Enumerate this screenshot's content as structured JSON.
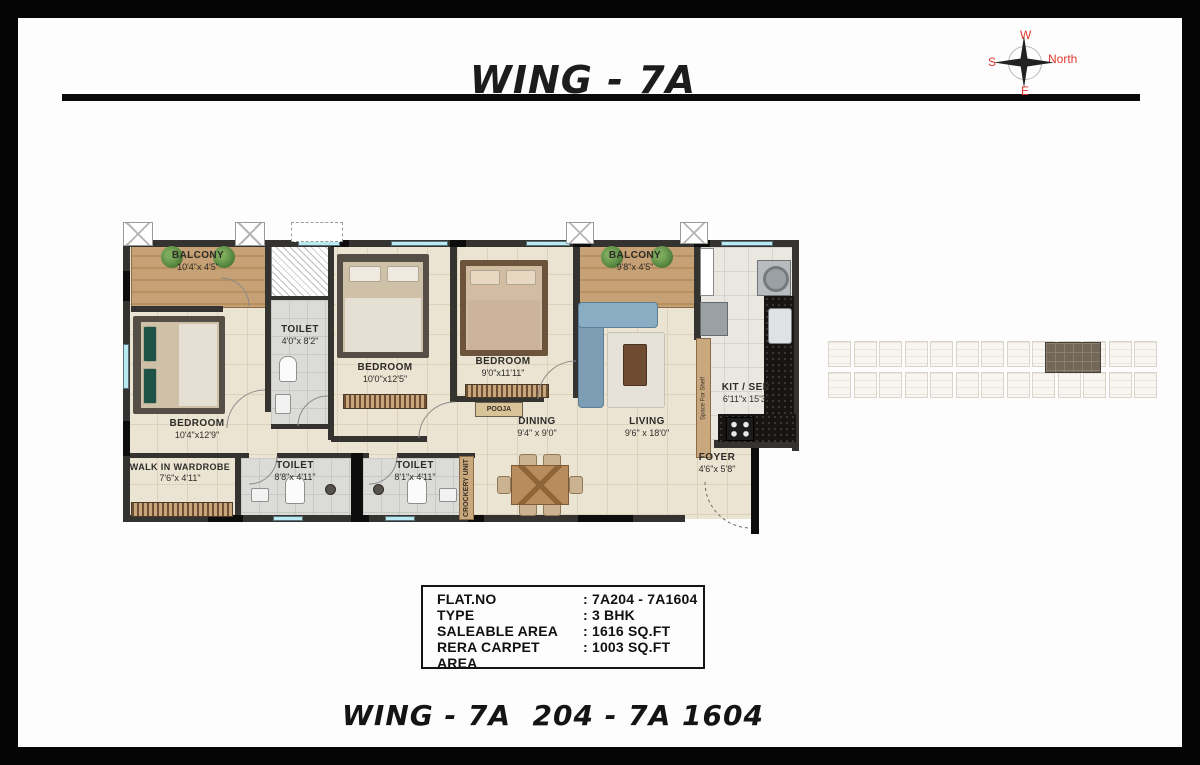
{
  "header": {
    "title": "WING - 7A"
  },
  "compass": {
    "top": "W",
    "left": "S",
    "right": "North",
    "bottom": "E"
  },
  "colors": {
    "compass_red": "#e2382c",
    "wall_dark": "#35332f",
    "floor_beige": "#ebe4d2",
    "counter_black": "#171513",
    "window_cyan": "#b9e9f1"
  },
  "plan": {
    "rooms": {
      "balcony1": {
        "name": "BALCONY",
        "dims": "10'4\"x 4'5\""
      },
      "toilet1": {
        "name": "TOILET",
        "dims": "4'0\"x 8'2\""
      },
      "bedroom2": {
        "name": "BEDROOM",
        "dims": "10'0\"x12'5\""
      },
      "bedroom3": {
        "name": "BEDROOM",
        "dims": "9'0\"x11'11\""
      },
      "balcony2": {
        "name": "BALCONY",
        "dims": "9'8\"x 4'5\""
      },
      "bedroom1": {
        "name": "BEDROOM",
        "dims": "10'4\"x12'9\""
      },
      "walk_in_wardrobe": {
        "name": "WALK IN WARDROBE",
        "dims": "7'6\"x 4'11\""
      },
      "toilet2": {
        "name": "TOILET",
        "dims": "8'8\"x 4'11\""
      },
      "toilet3": {
        "name": "TOILET",
        "dims": "8'1\"x 4'11\""
      },
      "pooja": {
        "name": "POOJA"
      },
      "dining": {
        "name": "DINING",
        "dims": "9'4\" x 9'0\""
      },
      "living": {
        "name": "LIVING",
        "dims": "9'6\" x 18'0\""
      },
      "kitchen": {
        "name": "KIT / SER",
        "dims": "6'11\"x 15'3\""
      },
      "foyer": {
        "name": "FOYER",
        "dims": "4'6\"x 5'8\""
      },
      "crockery": {
        "name": "CROCKERY UNIT"
      },
      "shelf": {
        "name": "Space For Shelf"
      }
    }
  },
  "info_table": {
    "rows": [
      {
        "label": "FLAT.NO",
        "value": ": 7A204 - 7A1604"
      },
      {
        "label": "TYPE",
        "value": ": 3 BHK"
      },
      {
        "label": "SALEABLE AREA",
        "value": ": 1616 SQ.FT"
      },
      {
        "label": "RERA CARPET AREA",
        "value": ": 1003 SQ.FT"
      }
    ]
  },
  "footer": {
    "title": "WING - 7A  204 - 7A 1604"
  }
}
